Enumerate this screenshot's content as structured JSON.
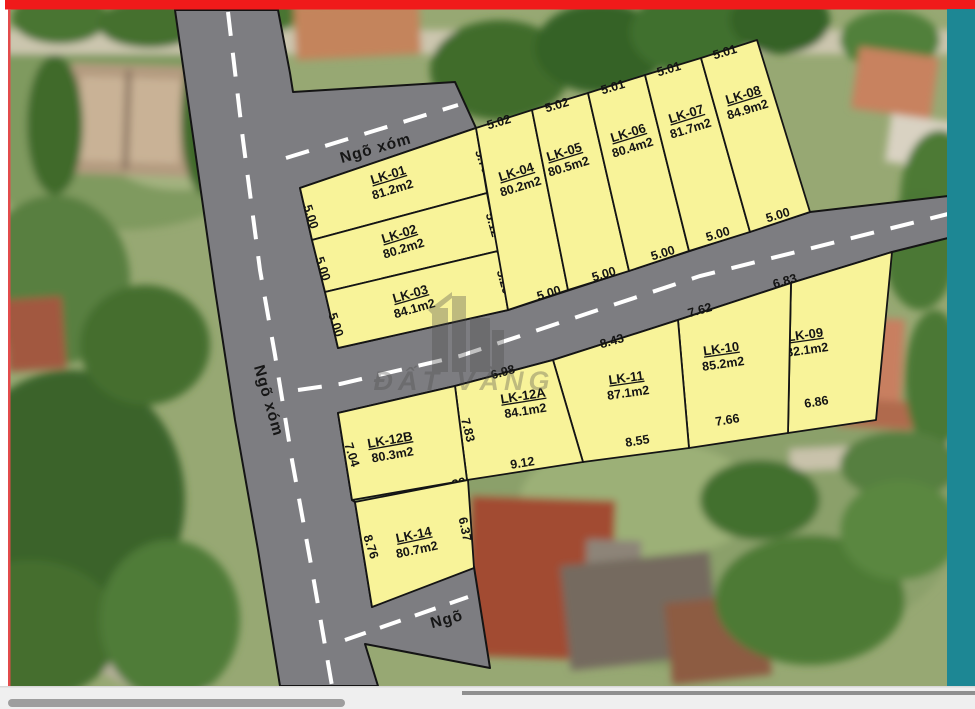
{
  "roads": {
    "north_label": "Ngõ xóm",
    "west_label": "Ngõ xóm",
    "south_label": "Ngõ"
  },
  "watermark": {
    "text": "ĐẤT VÀNG"
  },
  "colors": {
    "top_bar_red": "#f01a1a",
    "left_line_red": "#e34b4b",
    "right_stripe_teal": "#1d8794",
    "road_gray": "#7d7d81",
    "plot_yellow": "#f8f399",
    "outline_black": "#141414",
    "lane_dash_white": "#ffffff"
  },
  "plots": [
    {
      "id": "LK-01",
      "area": "81.2m2",
      "dims": {
        "left": "5.00",
        "right": "5.70"
      }
    },
    {
      "id": "LK-02",
      "area": "80.2m2",
      "dims": {
        "left": "5.00",
        "right": "5.12"
      }
    },
    {
      "id": "LK-03",
      "area": "84.1m2",
      "dims": {
        "left": "5.00",
        "right": "5.20"
      }
    },
    {
      "id": "LK-04",
      "area": "80.2m2",
      "dims": {
        "top": "5.02",
        "bottom": "5.00"
      }
    },
    {
      "id": "LK-05",
      "area": "80.5m2",
      "dims": {
        "top": "5.02",
        "bottom": "5.00"
      }
    },
    {
      "id": "LK-06",
      "area": "80.4m2",
      "dims": {
        "top": "5.01",
        "bottom": "5.00"
      }
    },
    {
      "id": "LK-07",
      "area": "81.7m2",
      "dims": {
        "top": "5.01",
        "bottom": "5.00"
      }
    },
    {
      "id": "LK-08",
      "area": "84.9m2",
      "dims": {
        "top": "5.01",
        "bottom": "5.00"
      }
    },
    {
      "id": "LK-09",
      "area": "82.1m2",
      "dims": {
        "top": "6.83",
        "bottom": "6.86"
      }
    },
    {
      "id": "LK-10",
      "area": "85.2m2",
      "dims": {
        "top": "7.62",
        "bottom": "7.66"
      }
    },
    {
      "id": "LK-11",
      "area": "87.1m2",
      "dims": {
        "top": "8.43",
        "bottom": "8.55"
      }
    },
    {
      "id": "LK-12A",
      "area": "84.1m2",
      "dims": {
        "top": "6.98",
        "bottom": "9.12",
        "left": "7.83"
      }
    },
    {
      "id": "LK-12B",
      "area": "80.3m2",
      "dims": {
        "left": "7.04",
        "corner": "39"
      }
    },
    {
      "id": "LK-14",
      "area": "80.7m2",
      "dims": {
        "left": "8.76",
        "right": "6.37"
      }
    }
  ]
}
